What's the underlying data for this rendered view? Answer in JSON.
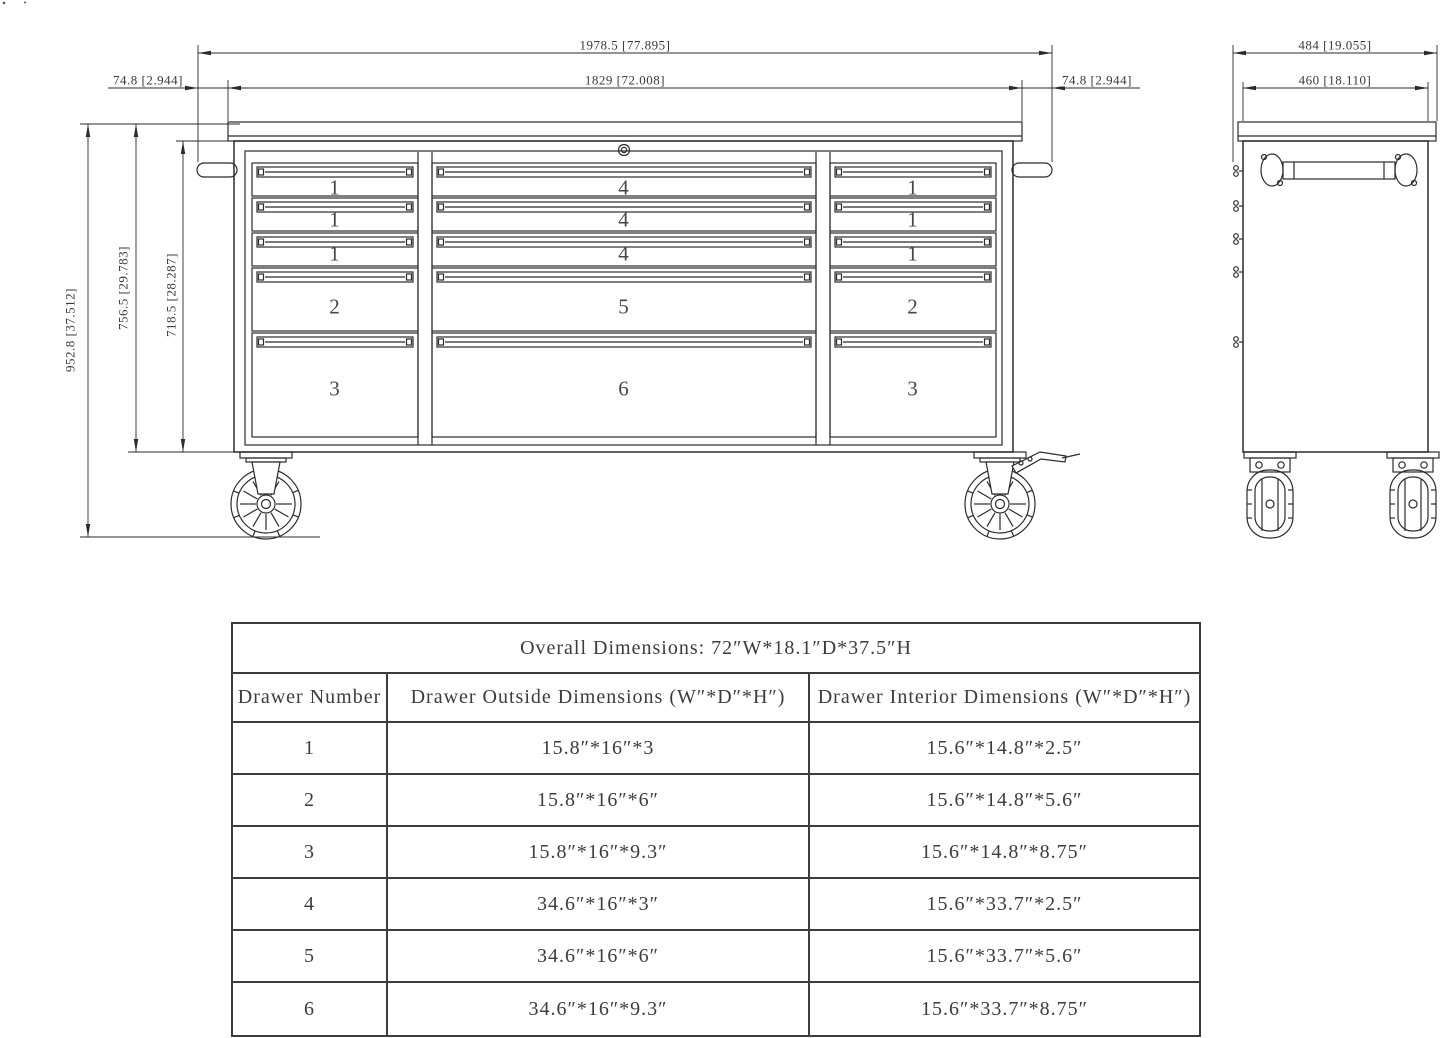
{
  "page": {
    "background": "#ffffff",
    "line_color": "#2b2b2b",
    "text_color": "#3a3a3a"
  },
  "front_view": {
    "dim_overall_width": "1978.5 [77.895]",
    "dim_body_width": "1829 [72.008]",
    "dim_left_handle": "74.8 [2.944]",
    "dim_right_handle": "74.8 [2.944]",
    "dim_overall_height": "952.8 [37.512]",
    "dim_cabinet_height": "756.5 [29.783]",
    "dim_drawer_section_height": "718.5 [28.287]",
    "drawer_labels": {
      "left": [
        "1",
        "1",
        "1",
        "2",
        "3"
      ],
      "center": [
        "4",
        "4",
        "4",
        "5",
        "6"
      ],
      "right": [
        "1",
        "1",
        "1",
        "2",
        "3"
      ]
    }
  },
  "side_view": {
    "dim_overall_depth": "484 [19.055]",
    "dim_body_depth": "460 [18.110]"
  },
  "spec_table": {
    "title": "Overall Dimensions: 72″W*18.1″D*37.5″H",
    "headers": [
      "Drawer Number",
      "Drawer Outside Dimensions (W″*D″*H″)",
      "Drawer Interior Dimensions (W″*D″*H″)"
    ],
    "rows": [
      [
        "1",
        "15.8″*16″*3",
        "15.6″*14.8″*2.5″"
      ],
      [
        "2",
        "15.8″*16″*6″",
        "15.6″*14.8″*5.6″"
      ],
      [
        "3",
        "15.8″*16″*9.3″",
        "15.6″*14.8″*8.75″"
      ],
      [
        "4",
        "34.6″*16″*3″",
        "15.6″*33.7″*2.5″"
      ],
      [
        "5",
        "34.6″*16″*6″",
        "15.6″*33.7″*5.6″"
      ],
      [
        "6",
        "34.6″*16″*9.3″",
        "15.6″*33.7″*8.75″"
      ]
    ]
  }
}
